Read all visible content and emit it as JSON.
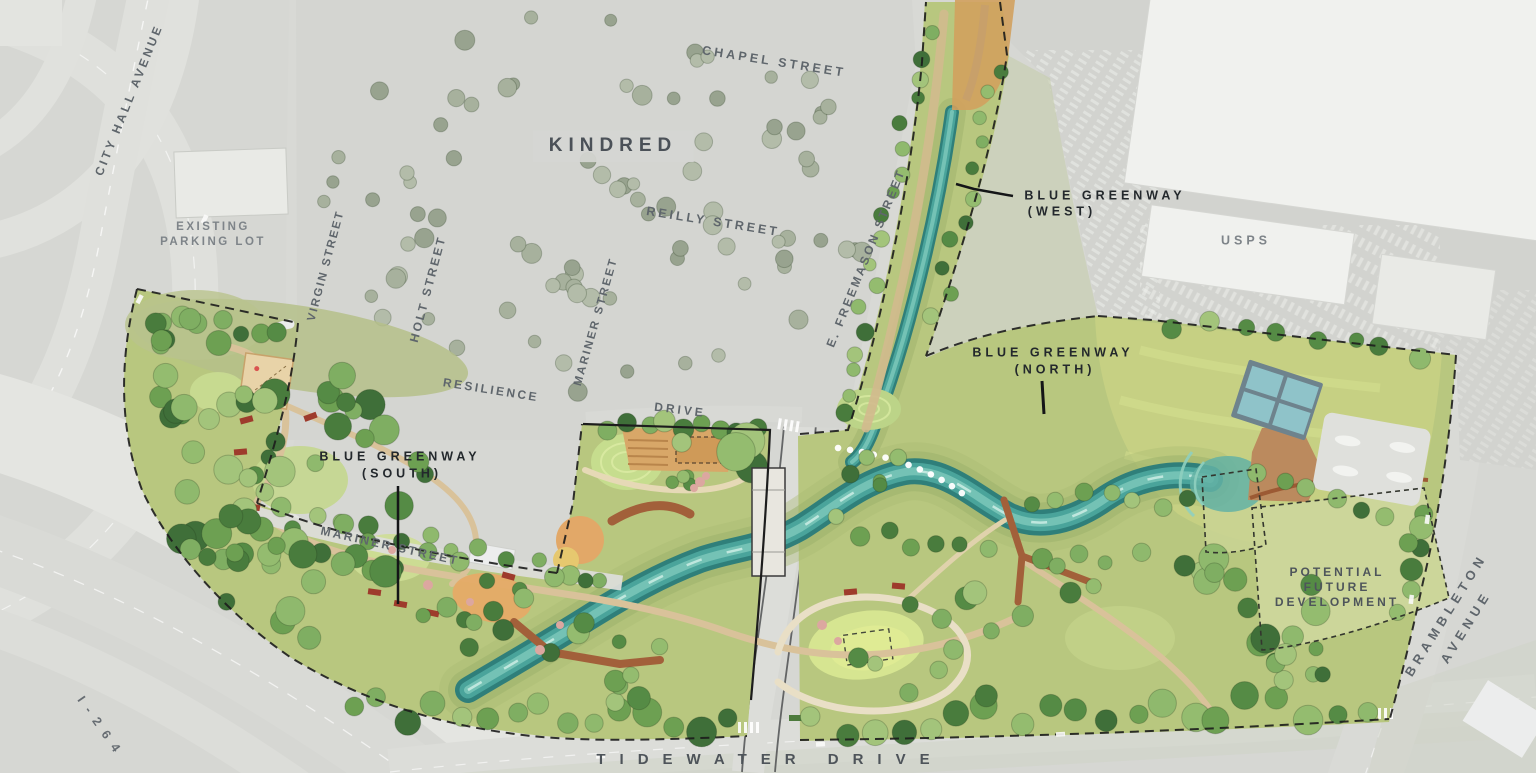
{
  "places": {
    "kindred": "KINDRED",
    "usps": "USPS",
    "existing_parking_line1": "EXISTING",
    "existing_parking_line2": "PARKING LOT"
  },
  "streets": {
    "city_hall_avenue": "CITY HALL AVENUE",
    "chapel": "CHAPEL STREET",
    "reilly": "REILLY STREET",
    "virgin": "VIRGIN STREET",
    "holt": "HOLT STREET",
    "mariner_north": "MARINER STREET",
    "resilience": "RESILIENCE",
    "drive": "DRIVE",
    "freemason": "E. FREEMASON STREET",
    "mariner_south": "MARINER STREET",
    "tidewater": "TIDEWATER DRIVE",
    "brambleton_line1": "BRAMBLETON",
    "brambleton_line2": "AVENUE",
    "i264": "I-264"
  },
  "annotations": {
    "west_line1": "BLUE GREENWAY",
    "west_line2": "(WEST)",
    "north_line1": "BLUE GREENWAY",
    "north_line2": "(NORTH)",
    "south_line1": "BLUE GREENWAY",
    "south_line2": "(SOUTH)",
    "future_line1": "POTENTIAL",
    "future_line2": "FUTURE",
    "future_line3": "DEVELOPMENT"
  },
  "colors": {
    "bg_gray": "#d6d7d3",
    "park_green": "#b8c77f",
    "meadow_green": "#c6d083",
    "stream_teal": "#4aa49b",
    "path_tan": "#d9c29a",
    "boardwalk_rust": "#a2603a",
    "court_blue": "#8fc3c9",
    "label_dark": "#23282c",
    "label_gray": "#5f666c"
  }
}
